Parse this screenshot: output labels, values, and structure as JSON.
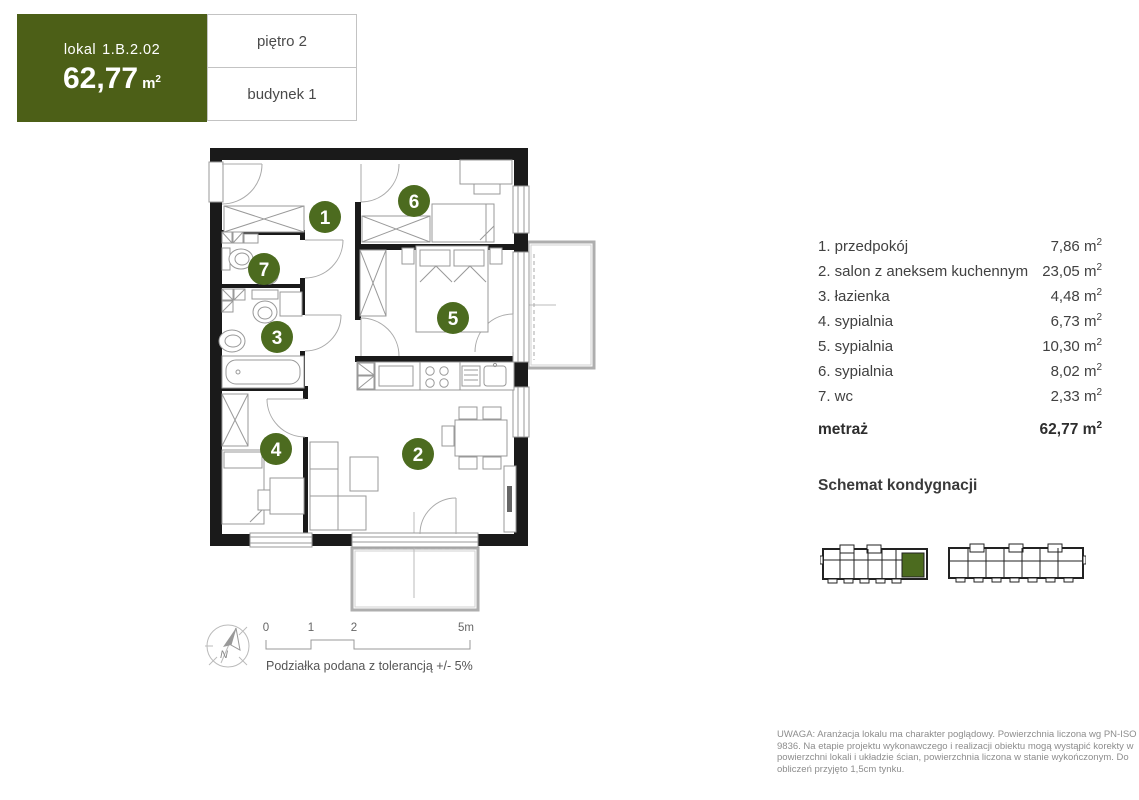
{
  "header": {
    "lokal_label": "lokal",
    "lokal_number": "1.B.2.02",
    "area_value": "62,77",
    "floor": "piętro 2",
    "building": "budynek 1"
  },
  "unit": {
    "base": "m",
    "sup": "2"
  },
  "rooms": [
    {
      "num": "1",
      "label": "1. przedpokój",
      "area": "7,86"
    },
    {
      "num": "2",
      "label": "2. salon z aneksem kuchennym",
      "area": "23,05"
    },
    {
      "num": "3",
      "label": "3. łazienka",
      "area": "4,48"
    },
    {
      "num": "4",
      "label": "4. sypialnia",
      "area": "6,73"
    },
    {
      "num": "5",
      "label": "5. sypialnia",
      "area": "10,30"
    },
    {
      "num": "6",
      "label": "6. sypialnia",
      "area": "8,02"
    },
    {
      "num": "7",
      "label": "7. wc",
      "area": "2,33"
    }
  ],
  "total": {
    "label": "metraż",
    "value": "62,77"
  },
  "floor_schematic": {
    "title": "Schemat kondygnacji"
  },
  "scale_bar": {
    "tick0": "0",
    "tick1": "1",
    "tick2": "2",
    "tick5": "5m",
    "tolerance_note": "Podziałka podana z tolerancją +/- 5%",
    "north": "N"
  },
  "disclaimer": "UWAGA: Aranżacja lokalu ma charakter poglądowy. Powierzchnia liczona wg PN-ISO 9836. Na etapie projektu wykonawczego i realizacji obiektu mogą wystąpić korekty w powierzchni lokali i układzie ścian, powierzchnia liczona w stanie wykończonym. Do obliczeń przyjęto 1,5cm tynku.",
  "colors": {
    "accent-green": "#4c5f17",
    "badge-green": "#4c6b1f",
    "wall-black": "#1a1a1a"
  }
}
